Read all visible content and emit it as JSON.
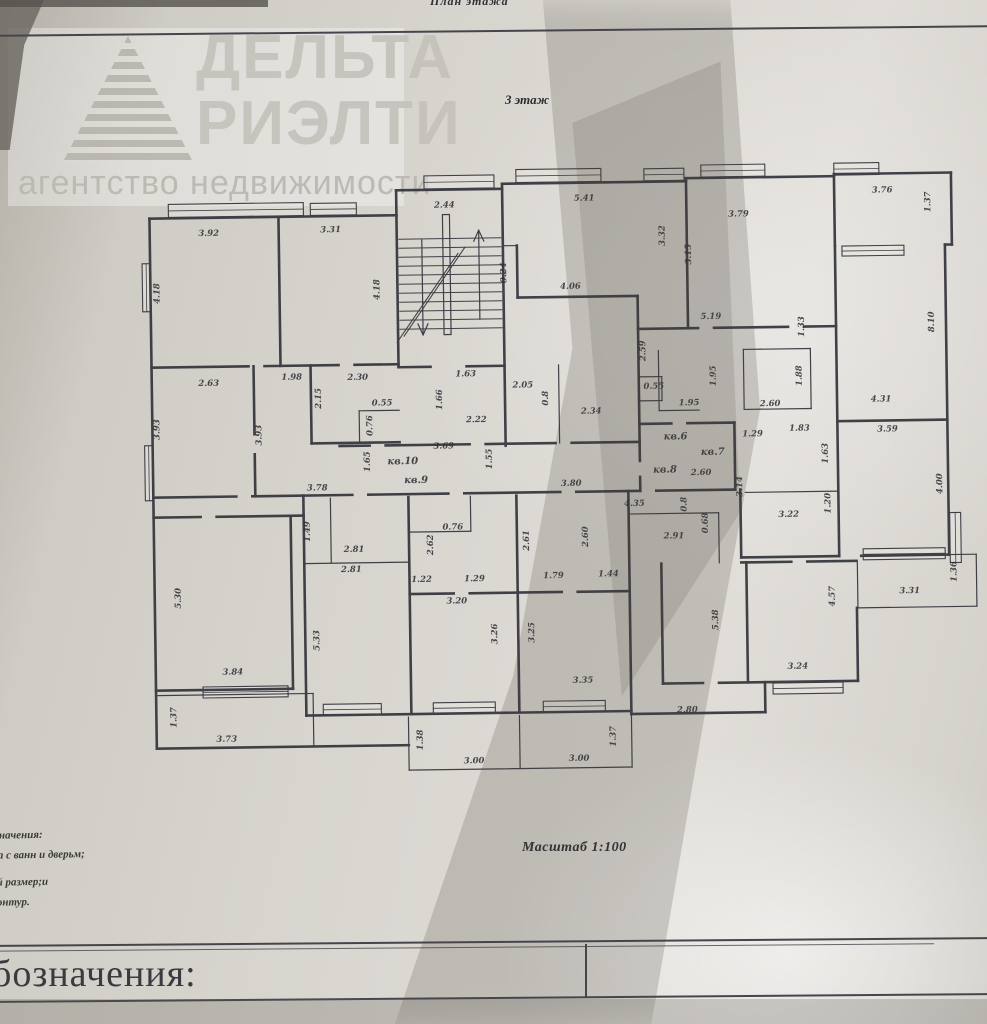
{
  "page": {
    "top_label": "План этажа",
    "floor_label": "3 этаж",
    "scale_label": "Масштаб 1:100",
    "bottom_section_title": "бозначения:"
  },
  "watermark": {
    "line1": "ДЕЛЬТА",
    "line2": "РИЭЛТИ",
    "line3": "агентство недвижимости"
  },
  "legend": {
    "lines": [
      "бозначения:",
      "тка с ванн и дверьм;",
      "вый размер;и",
      "у контур."
    ]
  },
  "apartment_labels": [
    "кв.6",
    "кв.7",
    "кв.8",
    "кв.9",
    "кв.10"
  ],
  "plan": {
    "wall_color": "#33333b",
    "label_color": "#23232b",
    "labels": [
      {
        "t": "2.44",
        "x": 448,
        "y": 206
      },
      {
        "t": "5.41",
        "x": 588,
        "y": 201
      },
      {
        "t": "3.32",
        "x": 668,
        "y": 237,
        "r": 1
      },
      {
        "t": "3.15",
        "x": 694,
        "y": 256,
        "r": 1
      },
      {
        "t": "3.79",
        "x": 742,
        "y": 219
      },
      {
        "t": "3.76",
        "x": 886,
        "y": 197
      },
      {
        "t": "1.37",
        "x": 934,
        "y": 207,
        "r": 1
      },
      {
        "t": "3.92",
        "x": 212,
        "y": 231
      },
      {
        "t": "3.31",
        "x": 334,
        "y": 229
      },
      {
        "t": "4.18",
        "x": 162,
        "y": 288,
        "r": 1
      },
      {
        "t": "4.18",
        "x": 382,
        "y": 287,
        "r": 1
      },
      {
        "t": "0.24",
        "x": 509,
        "y": 272,
        "r": 1
      },
      {
        "t": "4.06",
        "x": 573,
        "y": 289
      },
      {
        "t": "5.19",
        "x": 713,
        "y": 321
      },
      {
        "t": "1.33",
        "x": 806,
        "y": 330,
        "r": 1
      },
      {
        "t": "8.10",
        "x": 936,
        "y": 327,
        "r": 1
      },
      {
        "t": "2.59",
        "x": 647,
        "y": 352,
        "r": 1
      },
      {
        "t": "2.63",
        "x": 210,
        "y": 381
      },
      {
        "t": "1.98",
        "x": 293,
        "y": 376
      },
      {
        "t": "2.30",
        "x": 359,
        "y": 377
      },
      {
        "t": "2.15",
        "x": 322,
        "y": 395,
        "r": 1
      },
      {
        "t": "1.63",
        "x": 467,
        "y": 375
      },
      {
        "t": "1.66",
        "x": 443,
        "y": 398,
        "r": 1
      },
      {
        "t": "2.05",
        "x": 524,
        "y": 387
      },
      {
        "t": "0.8",
        "x": 549,
        "y": 398,
        "r": 1
      },
      {
        "t": "2.34",
        "x": 592,
        "y": 414
      },
      {
        "t": "0.55",
        "x": 655,
        "y": 390
      },
      {
        "t": "1.95",
        "x": 690,
        "y": 407
      },
      {
        "t": "1.95",
        "x": 717,
        "y": 378,
        "r": 1
      },
      {
        "t": "1.88",
        "x": 803,
        "y": 379,
        "r": 1
      },
      {
        "t": "2.60",
        "x": 771,
        "y": 409
      },
      {
        "t": "4.31",
        "x": 882,
        "y": 406
      },
      {
        "t": "3.93",
        "x": 160,
        "y": 424,
        "r": 1
      },
      {
        "t": "3.93",
        "x": 262,
        "y": 431,
        "r": 1
      },
      {
        "t": "0.55",
        "x": 383,
        "y": 403
      },
      {
        "t": "0.76",
        "x": 373,
        "y": 423,
        "r": 1
      },
      {
        "t": "2.22",
        "x": 477,
        "y": 421
      },
      {
        "t": "3.69",
        "x": 444,
        "y": 447
      },
      {
        "t": "1.65",
        "x": 370,
        "y": 459,
        "r": 1
      },
      {
        "t": "кв.10",
        "x": 403,
        "y": 462,
        "k": "apt"
      },
      {
        "t": "кв.9",
        "x": 416,
        "y": 481,
        "k": "apt"
      },
      {
        "t": "1.55",
        "x": 492,
        "y": 458,
        "r": 1
      },
      {
        "t": "3.80",
        "x": 571,
        "y": 486
      },
      {
        "t": "кв.6",
        "x": 676,
        "y": 441,
        "k": "apt"
      },
      {
        "t": "кв.7",
        "x": 713,
        "y": 457,
        "k": "apt"
      },
      {
        "t": "кв.8",
        "x": 665,
        "y": 474,
        "k": "apt"
      },
      {
        "t": "1.29",
        "x": 753,
        "y": 439
      },
      {
        "t": "1.83",
        "x": 800,
        "y": 434
      },
      {
        "t": "3.59",
        "x": 888,
        "y": 436
      },
      {
        "t": "1.63",
        "x": 828,
        "y": 457,
        "r": 1
      },
      {
        "t": "2.60",
        "x": 701,
        "y": 477
      },
      {
        "t": "3.14",
        "x": 742,
        "y": 489,
        "r": 1
      },
      {
        "t": "4.00",
        "x": 942,
        "y": 489,
        "r": 1
      },
      {
        "t": "3.78",
        "x": 317,
        "y": 487
      },
      {
        "t": "1.49",
        "x": 309,
        "y": 528,
        "r": 1
      },
      {
        "t": "2.81",
        "x": 353,
        "y": 549
      },
      {
        "t": "2.81",
        "x": 350,
        "y": 569
      },
      {
        "t": "0.76",
        "x": 452,
        "y": 528
      },
      {
        "t": "2.62",
        "x": 432,
        "y": 543,
        "r": 1
      },
      {
        "t": "2.61",
        "x": 528,
        "y": 540,
        "r": 1
      },
      {
        "t": "2.60",
        "x": 587,
        "y": 537,
        "r": 1
      },
      {
        "t": "4.35",
        "x": 634,
        "y": 507
      },
      {
        "t": "0.8",
        "x": 686,
        "y": 506,
        "r": 1
      },
      {
        "t": "0.68",
        "x": 707,
        "y": 525,
        "r": 1
      },
      {
        "t": "2.91",
        "x": 673,
        "y": 540
      },
      {
        "t": "1.20",
        "x": 830,
        "y": 507,
        "r": 1
      },
      {
        "t": "3.22",
        "x": 788,
        "y": 520
      },
      {
        "t": "1.36",
        "x": 955,
        "y": 577,
        "r": 1
      },
      {
        "t": "3.31",
        "x": 908,
        "y": 598
      },
      {
        "t": "1.22",
        "x": 420,
        "y": 580
      },
      {
        "t": "1.29",
        "x": 473,
        "y": 580
      },
      {
        "t": "1.79",
        "x": 552,
        "y": 578
      },
      {
        "t": "1.44",
        "x": 607,
        "y": 577
      },
      {
        "t": "3.20",
        "x": 455,
        "y": 602
      },
      {
        "t": "5.33",
        "x": 317,
        "y": 637,
        "r": 1
      },
      {
        "t": "3.26",
        "x": 495,
        "y": 633,
        "r": 1
      },
      {
        "t": "3.25",
        "x": 532,
        "y": 632,
        "r": 1
      },
      {
        "t": "5.30",
        "x": 179,
        "y": 593,
        "r": 1
      },
      {
        "t": "3.84",
        "x": 230,
        "y": 670
      },
      {
        "t": "3.35",
        "x": 580,
        "y": 683
      },
      {
        "t": "5.38",
        "x": 716,
        "y": 622,
        "r": 1
      },
      {
        "t": "4.57",
        "x": 833,
        "y": 600,
        "r": 1
      },
      {
        "t": "3.24",
        "x": 795,
        "y": 672
      },
      {
        "t": "1.37",
        "x": 173,
        "y": 712,
        "r": 1
      },
      {
        "t": "3.73",
        "x": 223,
        "y": 737
      },
      {
        "t": "1.38",
        "x": 419,
        "y": 738,
        "r": 1
      },
      {
        "t": "3.00",
        "x": 470,
        "y": 762
      },
      {
        "t": "1.37",
        "x": 612,
        "y": 737,
        "r": 1
      },
      {
        "t": "3.00",
        "x": 575,
        "y": 761
      },
      {
        "t": "2.80",
        "x": 684,
        "y": 714
      }
    ],
    "walls": [
      [
        153,
        213,
        400,
        213,
        "t"
      ],
      [
        400,
        188,
        400,
        365,
        "t"
      ],
      [
        400,
        188,
        506,
        188,
        "t"
      ],
      [
        506,
        183,
        506,
        445,
        "t"
      ],
      [
        506,
        183,
        690,
        183,
        "t"
      ],
      [
        690,
        180,
        690,
        330,
        "t"
      ],
      [
        690,
        180,
        838,
        180,
        "t"
      ],
      [
        838,
        178,
        955,
        178,
        "t"
      ],
      [
        838,
        178,
        838,
        250,
        "t"
      ],
      [
        955,
        178,
        955,
        250,
        "t"
      ],
      [
        948,
        250,
        955,
        250,
        "t"
      ],
      [
        948,
        250,
        948,
        560,
        "t"
      ],
      [
        860,
        560,
        948,
        560,
        "t"
      ],
      [
        856,
        565,
        856,
        612,
        "n"
      ],
      [
        856,
        612,
        975,
        612,
        "n"
      ],
      [
        975,
        560,
        975,
        612,
        "n"
      ],
      [
        948,
        560,
        975,
        560,
        "n"
      ],
      [
        855,
        612,
        855,
        685,
        "t"
      ],
      [
        660,
        685,
        700,
        685,
        "t"
      ],
      [
        716,
        685,
        855,
        685,
        "t"
      ],
      [
        762,
        685,
        762,
        715,
        "t"
      ],
      [
        628,
        715,
        762,
        715,
        "t"
      ],
      [
        153,
        213,
        153,
        743,
        "t"
      ],
      [
        153,
        743,
        405,
        743,
        "t"
      ],
      [
        400,
        365,
        432,
        365,
        "t"
      ],
      [
        468,
        365,
        506,
        365,
        "t"
      ],
      [
        282,
        213,
        282,
        362,
        "t"
      ],
      [
        153,
        362,
        250,
        362,
        "t"
      ],
      [
        266,
        362,
        340,
        362,
        "t"
      ],
      [
        356,
        362,
        400,
        362,
        "t"
      ],
      [
        255,
        362,
        255,
        430,
        "t"
      ],
      [
        255,
        450,
        255,
        492,
        "t"
      ],
      [
        312,
        362,
        312,
        440,
        "t"
      ],
      [
        312,
        440,
        400,
        440,
        "t"
      ],
      [
        360,
        408,
        400,
        408,
        "n"
      ],
      [
        360,
        408,
        360,
        440,
        "n"
      ],
      [
        153,
        492,
        236,
        492,
        "t"
      ],
      [
        252,
        492,
        352,
        492,
        "t"
      ],
      [
        368,
        492,
        448,
        492,
        "t"
      ],
      [
        464,
        492,
        560,
        492,
        "t"
      ],
      [
        576,
        492,
        640,
        492,
        "t"
      ],
      [
        656,
        492,
        735,
        492,
        "t"
      ],
      [
        340,
        443,
        370,
        443,
        "t"
      ],
      [
        386,
        443,
        470,
        443,
        "t"
      ],
      [
        486,
        443,
        556,
        443,
        "t"
      ],
      [
        572,
        443,
        640,
        443,
        "t"
      ],
      [
        520,
        297,
        640,
        297,
        "t"
      ],
      [
        506,
        245,
        520,
        245,
        "n"
      ],
      [
        520,
        245,
        520,
        297,
        "t"
      ],
      [
        640,
        297,
        640,
        443,
        "t"
      ],
      [
        560,
        365,
        560,
        443,
        "n"
      ],
      [
        640,
        330,
        700,
        330,
        "t"
      ],
      [
        716,
        330,
        790,
        330,
        "t"
      ],
      [
        806,
        330,
        838,
        330,
        "t"
      ],
      [
        745,
        352,
        812,
        352,
        "n"
      ],
      [
        812,
        352,
        812,
        412,
        "n"
      ],
      [
        745,
        412,
        812,
        412,
        "n"
      ],
      [
        745,
        352,
        745,
        412,
        "n"
      ],
      [
        660,
        352,
        660,
        412,
        "n"
      ],
      [
        660,
        412,
        700,
        412,
        "n"
      ],
      [
        640,
        378,
        663,
        378,
        "n"
      ],
      [
        663,
        378,
        663,
        402,
        "n"
      ],
      [
        640,
        402,
        663,
        402,
        "n"
      ],
      [
        640,
        378,
        640,
        402,
        "n"
      ],
      [
        640,
        425,
        672,
        425,
        "t"
      ],
      [
        688,
        425,
        735,
        425,
        "t"
      ],
      [
        735,
        425,
        735,
        492,
        "t"
      ],
      [
        838,
        250,
        838,
        425,
        "t"
      ],
      [
        838,
        425,
        948,
        425,
        "t"
      ],
      [
        838,
        425,
        838,
        560,
        "t"
      ],
      [
        740,
        492,
        740,
        560,
        "t"
      ],
      [
        740,
        560,
        838,
        560,
        "t"
      ],
      [
        745,
        495,
        838,
        495,
        "n"
      ],
      [
        640,
        443,
        640,
        462,
        "t"
      ],
      [
        640,
        478,
        640,
        492,
        "t"
      ],
      [
        628,
        515,
        718,
        515,
        "n"
      ],
      [
        718,
        515,
        718,
        565,
        "n"
      ],
      [
        740,
        565,
        790,
        565,
        "t"
      ],
      [
        806,
        565,
        855,
        565,
        "t"
      ],
      [
        660,
        565,
        660,
        685,
        "t"
      ],
      [
        745,
        565,
        745,
        685,
        "t"
      ],
      [
        303,
        492,
        303,
        712,
        "t"
      ],
      [
        408,
        495,
        408,
        712,
        "t"
      ],
      [
        516,
        495,
        516,
        712,
        "t"
      ],
      [
        628,
        492,
        628,
        715,
        "t"
      ],
      [
        330,
        495,
        330,
        560,
        "n"
      ],
      [
        303,
        560,
        408,
        560,
        "n"
      ],
      [
        408,
        592,
        452,
        592,
        "t"
      ],
      [
        468,
        592,
        516,
        592,
        "t"
      ],
      [
        516,
        592,
        560,
        592,
        "t"
      ],
      [
        576,
        592,
        628,
        592,
        "t"
      ],
      [
        408,
        530,
        470,
        530,
        "n"
      ],
      [
        470,
        495,
        470,
        530,
        "n"
      ],
      [
        303,
        712,
        628,
        712,
        "t"
      ],
      [
        405,
        715,
        405,
        768,
        "n"
      ],
      [
        516,
        715,
        516,
        768,
        "n"
      ],
      [
        628,
        715,
        628,
        768,
        "n"
      ],
      [
        405,
        768,
        628,
        768,
        "n"
      ],
      [
        153,
        512,
        200,
        512,
        "t"
      ],
      [
        216,
        512,
        303,
        512,
        "t"
      ],
      [
        290,
        512,
        290,
        685,
        "t"
      ],
      [
        153,
        685,
        290,
        685,
        "t"
      ],
      [
        155,
        690,
        310,
        690,
        "n"
      ],
      [
        310,
        690,
        310,
        743,
        "n"
      ]
    ],
    "windows": [
      [
        172,
        199,
        135,
        13
      ],
      [
        314,
        200,
        46,
        12
      ],
      [
        428,
        174,
        70,
        13
      ],
      [
        520,
        169,
        85,
        13
      ],
      [
        648,
        170,
        40,
        12
      ],
      [
        705,
        167,
        64,
        12
      ],
      [
        838,
        167,
        45,
        12
      ],
      [
        845,
        250,
        62,
        10
      ],
      [
        145,
        258,
        8,
        48
      ],
      [
        145,
        440,
        8,
        55
      ],
      [
        949,
        518,
        11,
        50
      ],
      [
        862,
        553,
        82,
        11
      ],
      [
        770,
        686,
        70,
        11
      ],
      [
        200,
        682,
        85,
        11
      ],
      [
        320,
        701,
        58,
        11
      ],
      [
        430,
        701,
        62,
        11
      ],
      [
        540,
        701,
        62,
        11
      ]
    ],
    "stairs": {
      "tread_x1": 402,
      "tread_x2": 504,
      "tread_y0": 237,
      "tread_step": 9,
      "tread_count": 11,
      "stringer": [
        446,
        213,
        7,
        120
      ],
      "diagonals": [
        [
          406,
          334,
          468,
          246
        ],
        [
          399,
          340,
          461,
          252
        ]
      ],
      "arrows": [
        {
          "line": [
            482,
            318,
            482,
            230
          ],
          "head": [
            [
              477,
              240,
              482,
              229
            ],
            [
              487,
              240,
              482,
              229
            ]
          ]
        },
        {
          "line": [
            425,
            238,
            425,
            332
          ],
          "head": [
            [
              420,
              322,
              425,
              333
            ],
            [
              430,
              322,
              425,
              333
            ]
          ]
        }
      ]
    }
  }
}
